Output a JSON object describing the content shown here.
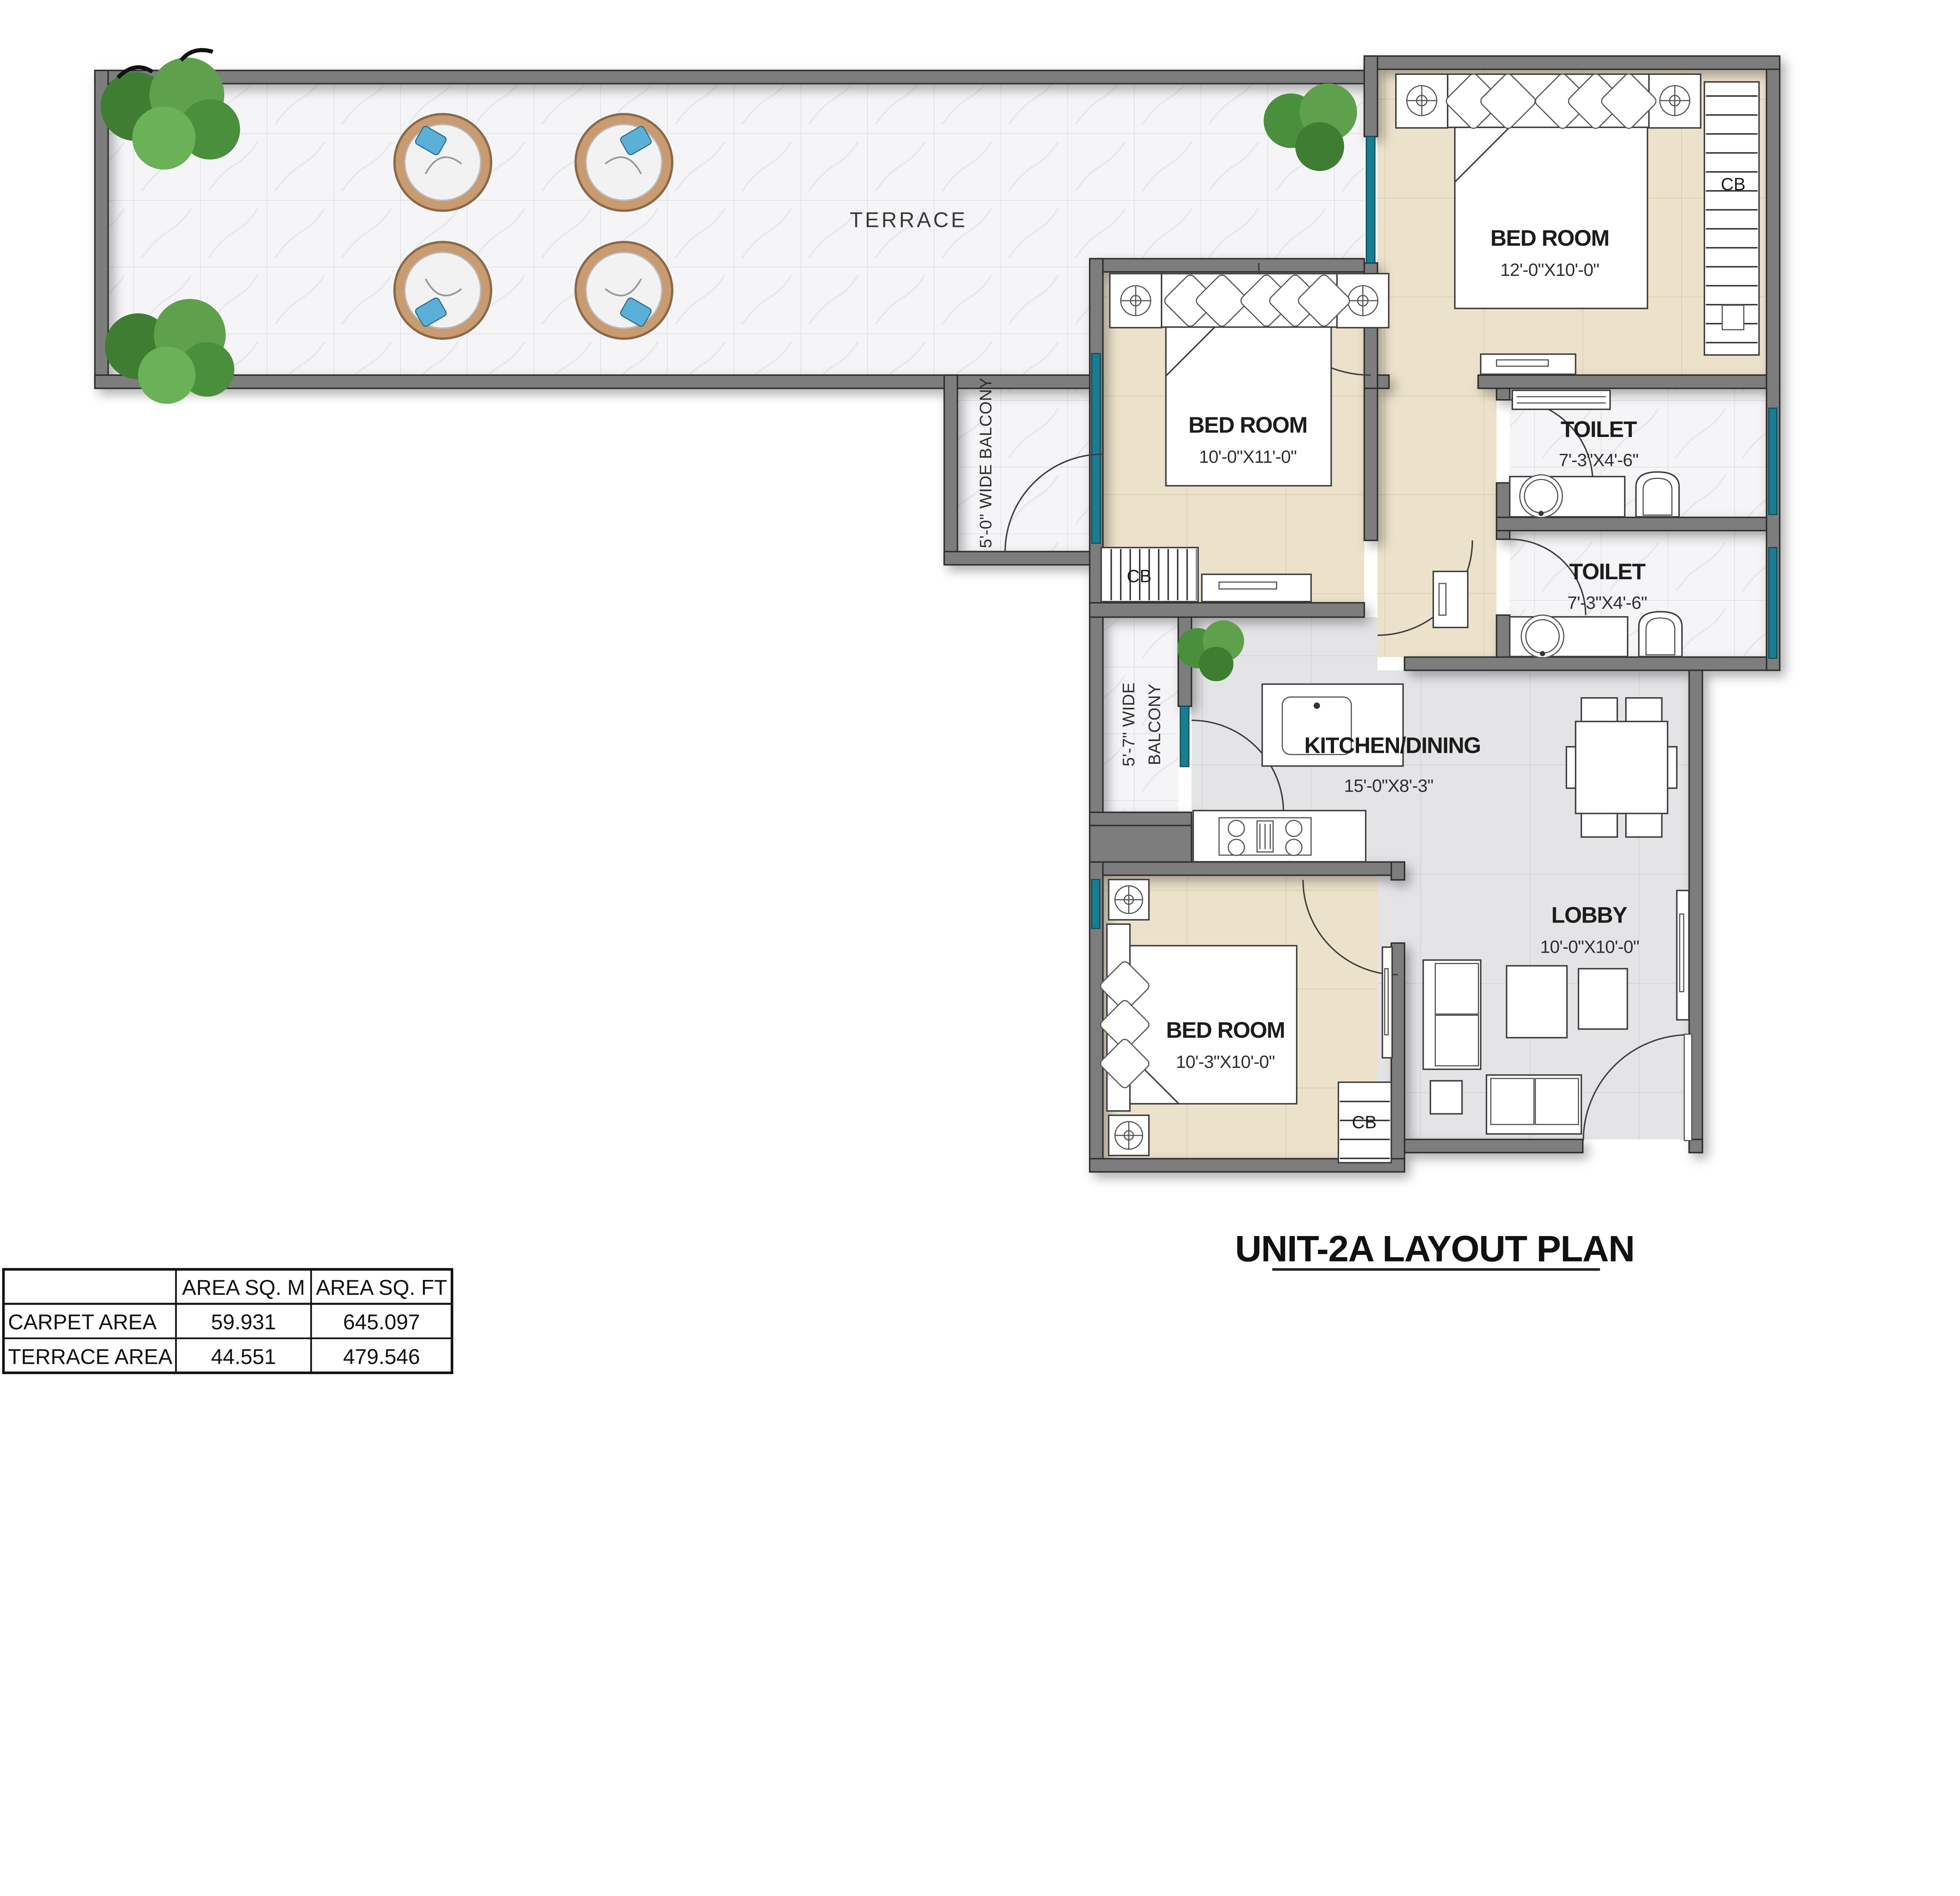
{
  "title": "UNIT-2A LAYOUT PLAN",
  "labels": {
    "cb": "CB",
    "terrace": "TERRACE"
  },
  "rooms": {
    "bedroom1": {
      "name": "BED ROOM",
      "dims": "12'-0\"X10'-0\""
    },
    "bedroom2": {
      "name": "BED ROOM",
      "dims": "10'-0\"X11'-0\""
    },
    "bedroom3": {
      "name": "BED ROOM",
      "dims": "10'-3\"X10'-0\""
    },
    "toilet1": {
      "name": "TOILET",
      "dims": "7'-3\"X4'-6\""
    },
    "toilet2": {
      "name": "TOILET",
      "dims": "7'-3\"X4'-6\""
    },
    "kitchen": {
      "name": "KITCHEN/DINING",
      "dims": "15'-0\"X8'-3\""
    },
    "lobby": {
      "name": "LOBBY",
      "dims": "10'-0\"X10'-0\""
    },
    "balcony1": {
      "name": "5'-0\" WIDE BALCONY"
    },
    "balcony2": {
      "line1": "5'-7\" WIDE",
      "line2": "BALCONY"
    }
  },
  "area_table": {
    "headers": [
      "",
      "AREA SQ. M",
      "AREA SQ. FT"
    ],
    "rows": [
      {
        "label": "CARPET AREA",
        "sq_m": "59.931",
        "sq_ft": "645.097"
      },
      {
        "label": "TERRACE AREA",
        "sq_m": "44.551",
        "sq_ft": "479.546"
      }
    ]
  },
  "colors": {
    "wall": "#7d7d7d",
    "window_teal": "#187d90",
    "floor_marble": "#f5f5f7",
    "floor_beige": "#ece2cb",
    "floor_gray": "#e4e4e7",
    "rattan": "#c89b70",
    "pillow_blue": "#5bb0d8"
  }
}
